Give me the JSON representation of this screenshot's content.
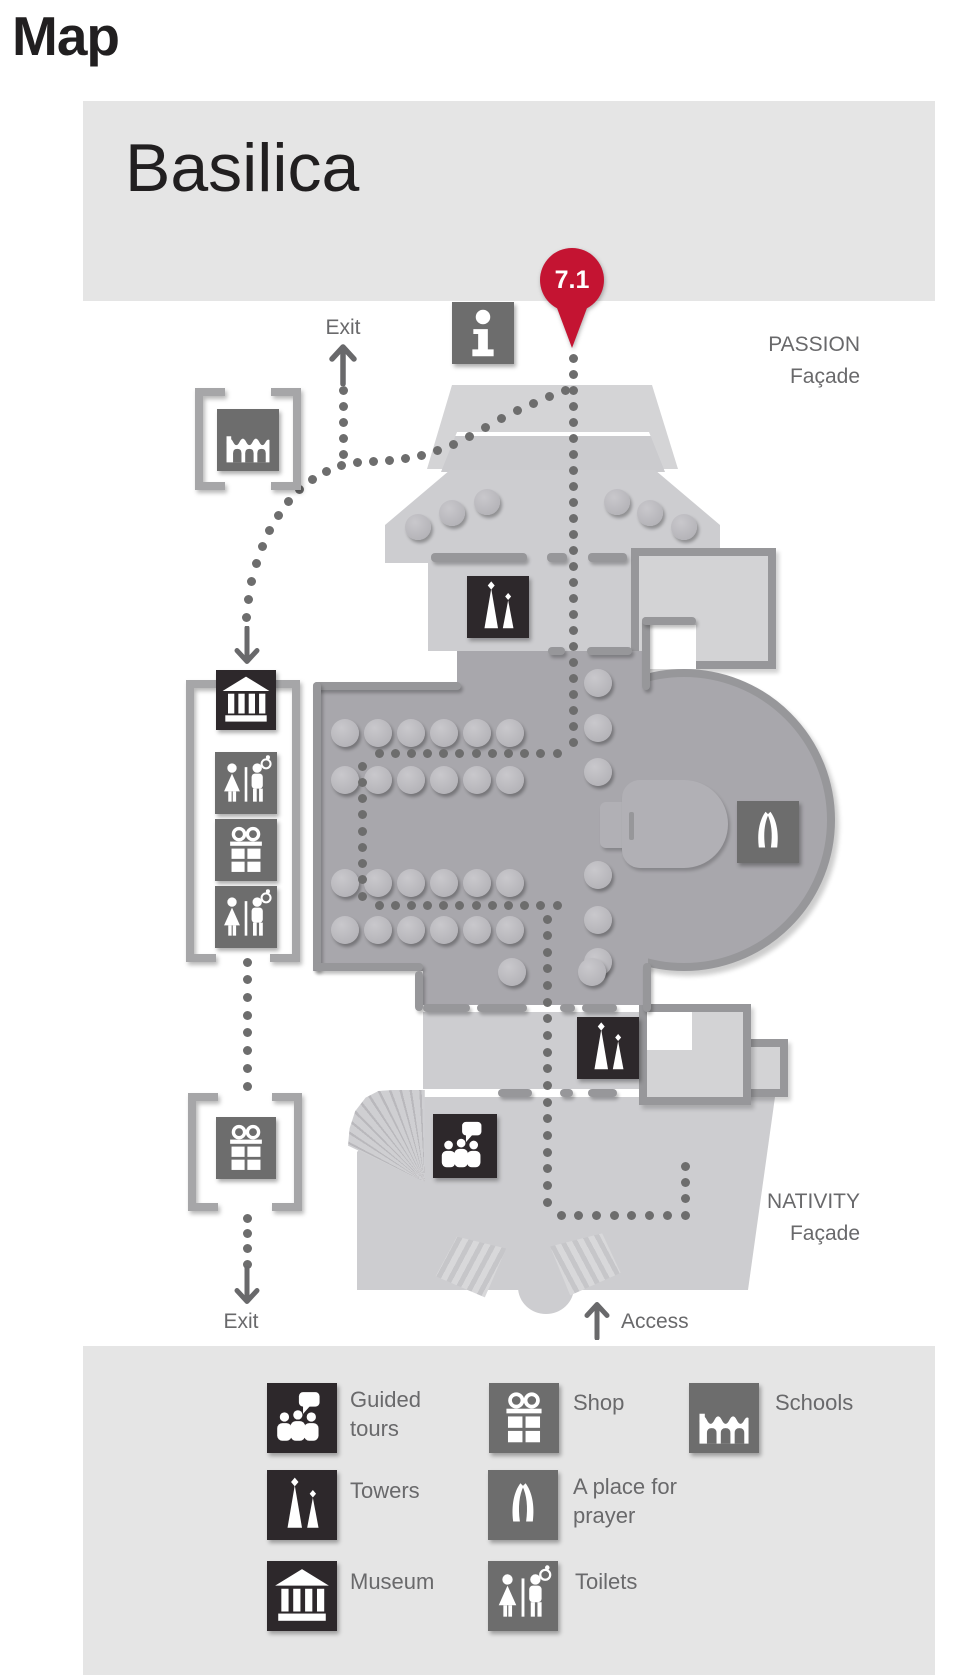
{
  "page": {
    "title": "Map"
  },
  "map": {
    "header_title": "Basilica",
    "pin_label": "7.1",
    "labels": {
      "exit_top": "Exit",
      "exit_bottom": "Exit",
      "access": "Access",
      "passion_line1": "PASSION",
      "passion_line2": "Façade",
      "nativity_line1": "NATIVITY",
      "nativity_line2": "Façade"
    },
    "plan_icons": [
      "information",
      "towers-passion",
      "towers-nativity",
      "place-for-prayer",
      "guided-tours",
      "schools",
      "museum",
      "toilets-upper",
      "shop-upper",
      "toilets-lower",
      "shop-exit"
    ]
  },
  "legend": {
    "items": [
      {
        "id": "guided-tours",
        "label": "Guided tours",
        "style": "dark"
      },
      {
        "id": "shop",
        "label": "Shop",
        "style": "gray"
      },
      {
        "id": "schools",
        "label": "Schools",
        "style": "gray"
      },
      {
        "id": "towers",
        "label": "Towers",
        "style": "dark"
      },
      {
        "id": "prayer",
        "label": "A place for prayer",
        "style": "gray"
      },
      {
        "id": "museum",
        "label": "Museum",
        "style": "dark"
      },
      {
        "id": "toilets",
        "label": "Toilets",
        "style": "gray"
      }
    ]
  },
  "colors": {
    "accent_red": "#c41432",
    "icon_dark": "#2d282b",
    "icon_gray": "#6d6d6d",
    "wall_gray": "#97979a",
    "nave_gray": "#a8a7ac",
    "light_gray": "#cdcdd0",
    "panel_gray": "#e5e5e5",
    "text_dark": "#211f20",
    "text_gray": "#69696b"
  }
}
